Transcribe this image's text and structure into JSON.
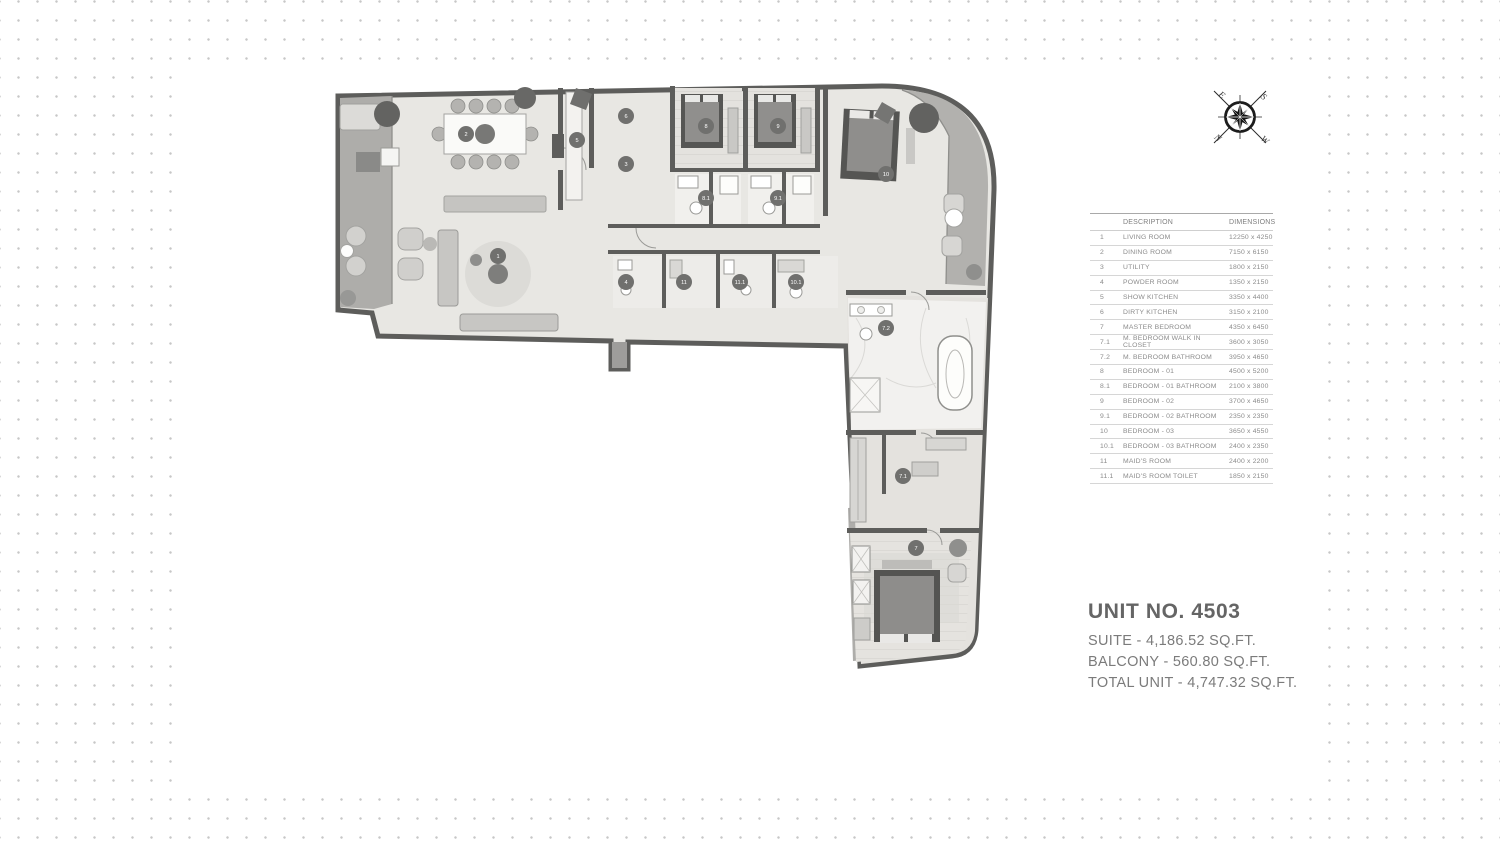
{
  "spec_table": {
    "headers": {
      "description": "DESCRIPTION",
      "dimensions": "DIMENSIONS"
    },
    "rows": [
      {
        "no": "1",
        "description": "LIVING ROOM",
        "dimensions": "12250 x 4250"
      },
      {
        "no": "2",
        "description": "DINING ROOM",
        "dimensions": "7150 x 6150"
      },
      {
        "no": "3",
        "description": "UTILITY",
        "dimensions": "1800 x 2150"
      },
      {
        "no": "4",
        "description": "POWDER ROOM",
        "dimensions": "1350 x 2150"
      },
      {
        "no": "5",
        "description": "SHOW KITCHEN",
        "dimensions": "3350 x 4400"
      },
      {
        "no": "6",
        "description": "DIRTY KITCHEN",
        "dimensions": "3150 x 2100"
      },
      {
        "no": "7",
        "description": "MASTER BEDROOM",
        "dimensions": "4350 x 6450"
      },
      {
        "no": "7.1",
        "description": "M. BEDROOM WALK IN CLOSET",
        "dimensions": "3600 x 3050"
      },
      {
        "no": "7.2",
        "description": "M. BEDROOM BATHROOM",
        "dimensions": "3950 x 4650"
      },
      {
        "no": "8",
        "description": "BEDROOM - 01",
        "dimensions": "4500 x 5200"
      },
      {
        "no": "8.1",
        "description": "BEDROOM -  01 BATHROOM",
        "dimensions": "2100 x 3800"
      },
      {
        "no": "9",
        "description": "BEDROOM - 02",
        "dimensions": "3700 x 4650"
      },
      {
        "no": "9.1",
        "description": "BEDROOM - 02 BATHROOM",
        "dimensions": "2350 x 2350"
      },
      {
        "no": "10",
        "description": "BEDROOM - 03",
        "dimensions": "3650 x 4550"
      },
      {
        "no": "10.1",
        "description": "BEDROOM - 03 BATHROOM",
        "dimensions": "2400 x 2350"
      },
      {
        "no": "11",
        "description": "MAID'S ROOM",
        "dimensions": "2400 x 2200"
      },
      {
        "no": "11.1",
        "description": "MAID'S ROOM TOILET",
        "dimensions": "1850 x 2150"
      }
    ]
  },
  "unit_info": {
    "title": "UNIT NO. 4503",
    "lines": [
      "SUITE - 4,186.52 SQ.FT.",
      "BALCONY - 560.80 SQ.FT.",
      "TOTAL UNIT - 4,747.32 SQ.FT."
    ]
  },
  "compass": {
    "letters": [
      {
        "label": "E",
        "x": 15,
        "y": 15
      },
      {
        "label": "S",
        "x": 57,
        "y": 17
      },
      {
        "label": "W",
        "x": 58,
        "y": 60
      },
      {
        "label": "N",
        "x": 11,
        "y": 58
      }
    ]
  },
  "floor_plan": {
    "room_markers": [
      {
        "no": "1",
        "x": 172,
        "y": 178
      },
      {
        "no": "2",
        "x": 140,
        "y": 56
      },
      {
        "no": "3",
        "x": 300,
        "y": 86
      },
      {
        "no": "4",
        "x": 300,
        "y": 204
      },
      {
        "no": "5",
        "x": 251,
        "y": 62
      },
      {
        "no": "6",
        "x": 300,
        "y": 38
      },
      {
        "no": "7",
        "x": 590,
        "y": 470
      },
      {
        "no": "7.1",
        "x": 577,
        "y": 398
      },
      {
        "no": "7.2",
        "x": 560,
        "y": 250
      },
      {
        "no": "8",
        "x": 380,
        "y": 48
      },
      {
        "no": "8.1",
        "x": 380,
        "y": 120
      },
      {
        "no": "9",
        "x": 452,
        "y": 48
      },
      {
        "no": "9.1",
        "x": 452,
        "y": 120
      },
      {
        "no": "10",
        "x": 560,
        "y": 96
      },
      {
        "no": "10.1",
        "x": 470,
        "y": 204
      },
      {
        "no": "11",
        "x": 358,
        "y": 204
      },
      {
        "no": "11.1",
        "x": 414,
        "y": 204
      }
    ]
  },
  "colors": {
    "wall": "#5d5d5b",
    "floor": "#e8e7e3",
    "balcony": "#aeadaa",
    "marker": "#70706e"
  }
}
